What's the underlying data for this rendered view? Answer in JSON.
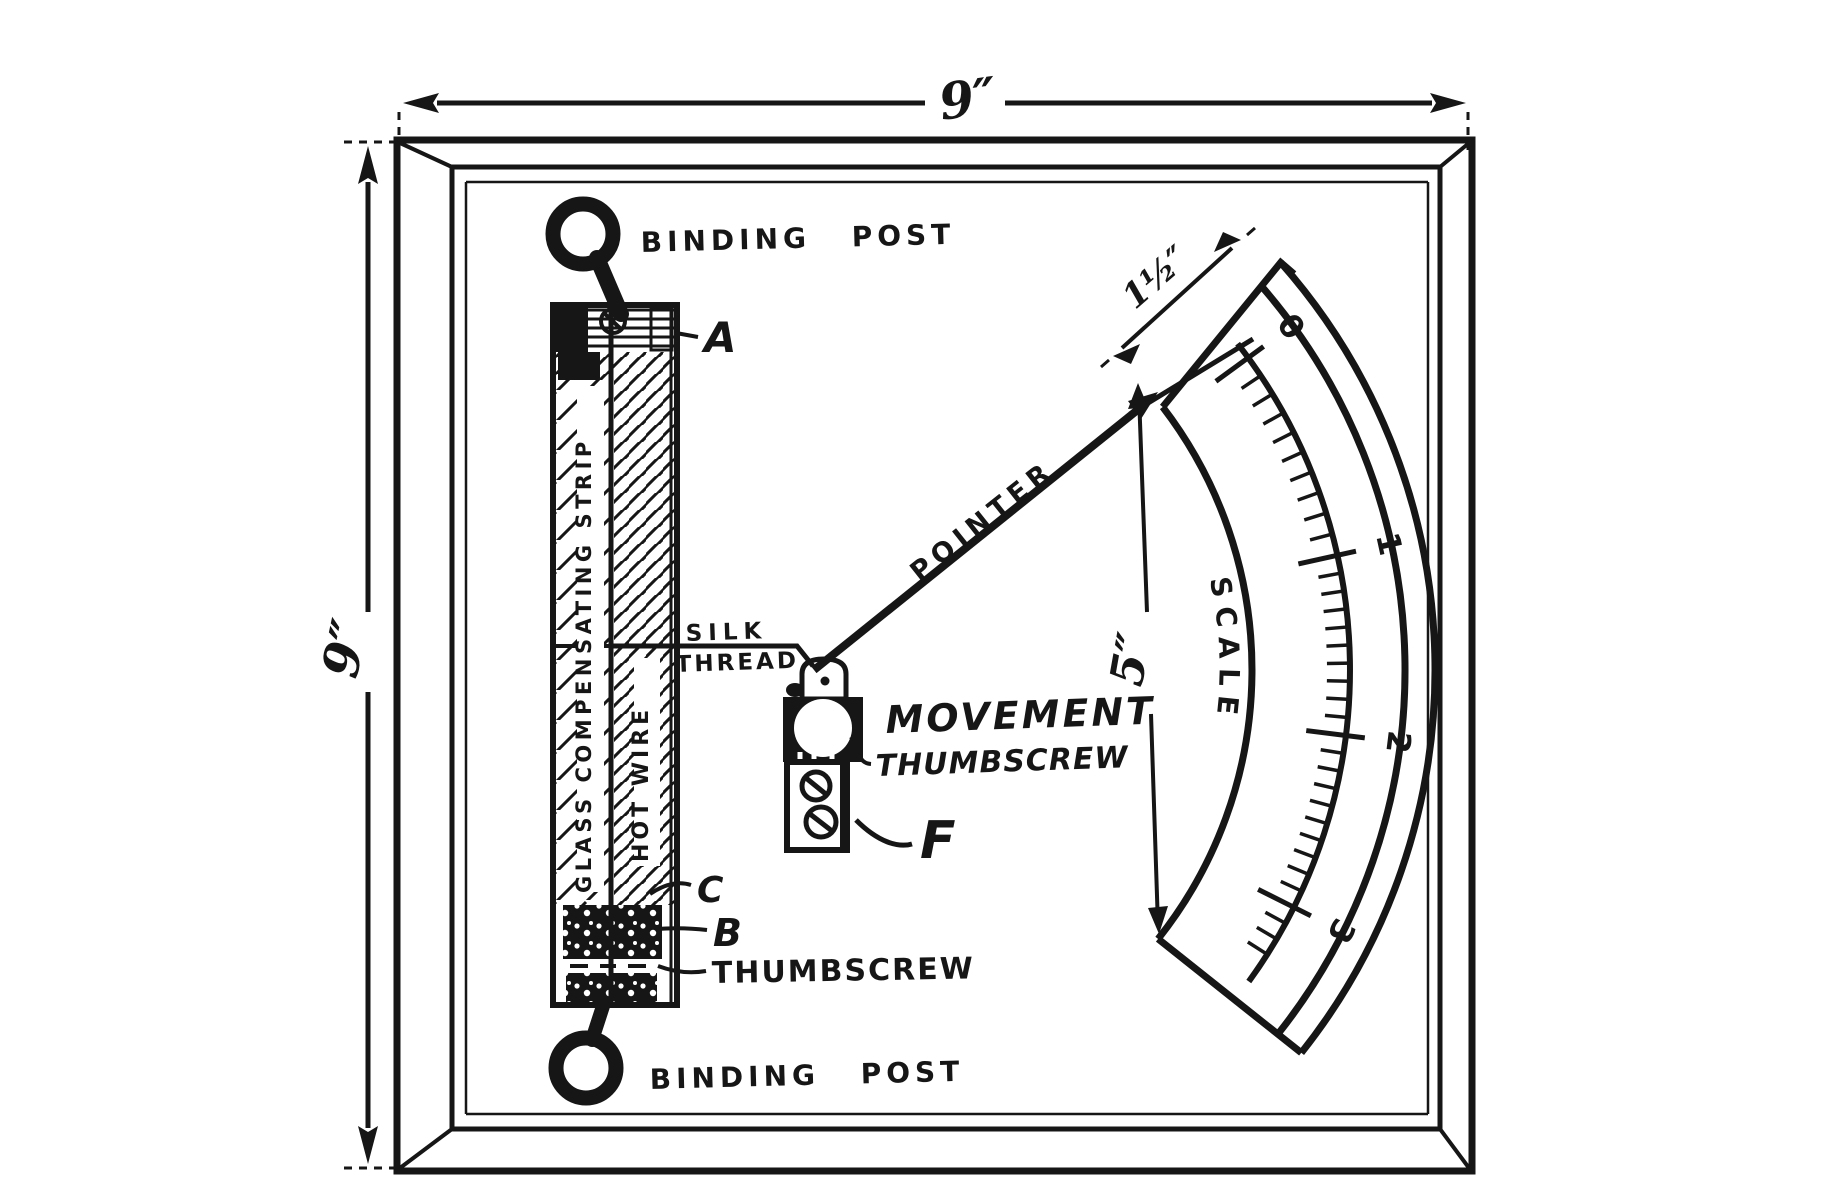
{
  "dims": {
    "board_width": "9″",
    "board_height": "9″",
    "scale_edge": "1½″",
    "scale_chord": "5″"
  },
  "labels": {
    "binding_post_top": "BINDING POST",
    "binding_post_bottom": "BINDING POST",
    "glass_strip": "GLASS COMPENSATING STRIP",
    "hot_wire": "HOT WIRE",
    "silk_line1": "SILK",
    "silk_line2": "THREAD",
    "pointer": "POINTER",
    "movement": "MOVEMENT",
    "movement_thumbscrew": "THUMBSCREW",
    "bottom_thumbscrew": "THUMBSCREW",
    "part_a": "A",
    "part_b": "B",
    "part_c": "C",
    "part_f": "F"
  },
  "scale": {
    "name": "SCALE",
    "values": [
      "0",
      "1",
      "2",
      "3"
    ]
  },
  "colors": {
    "ink": "#161616",
    "paper": "#ffffff"
  }
}
